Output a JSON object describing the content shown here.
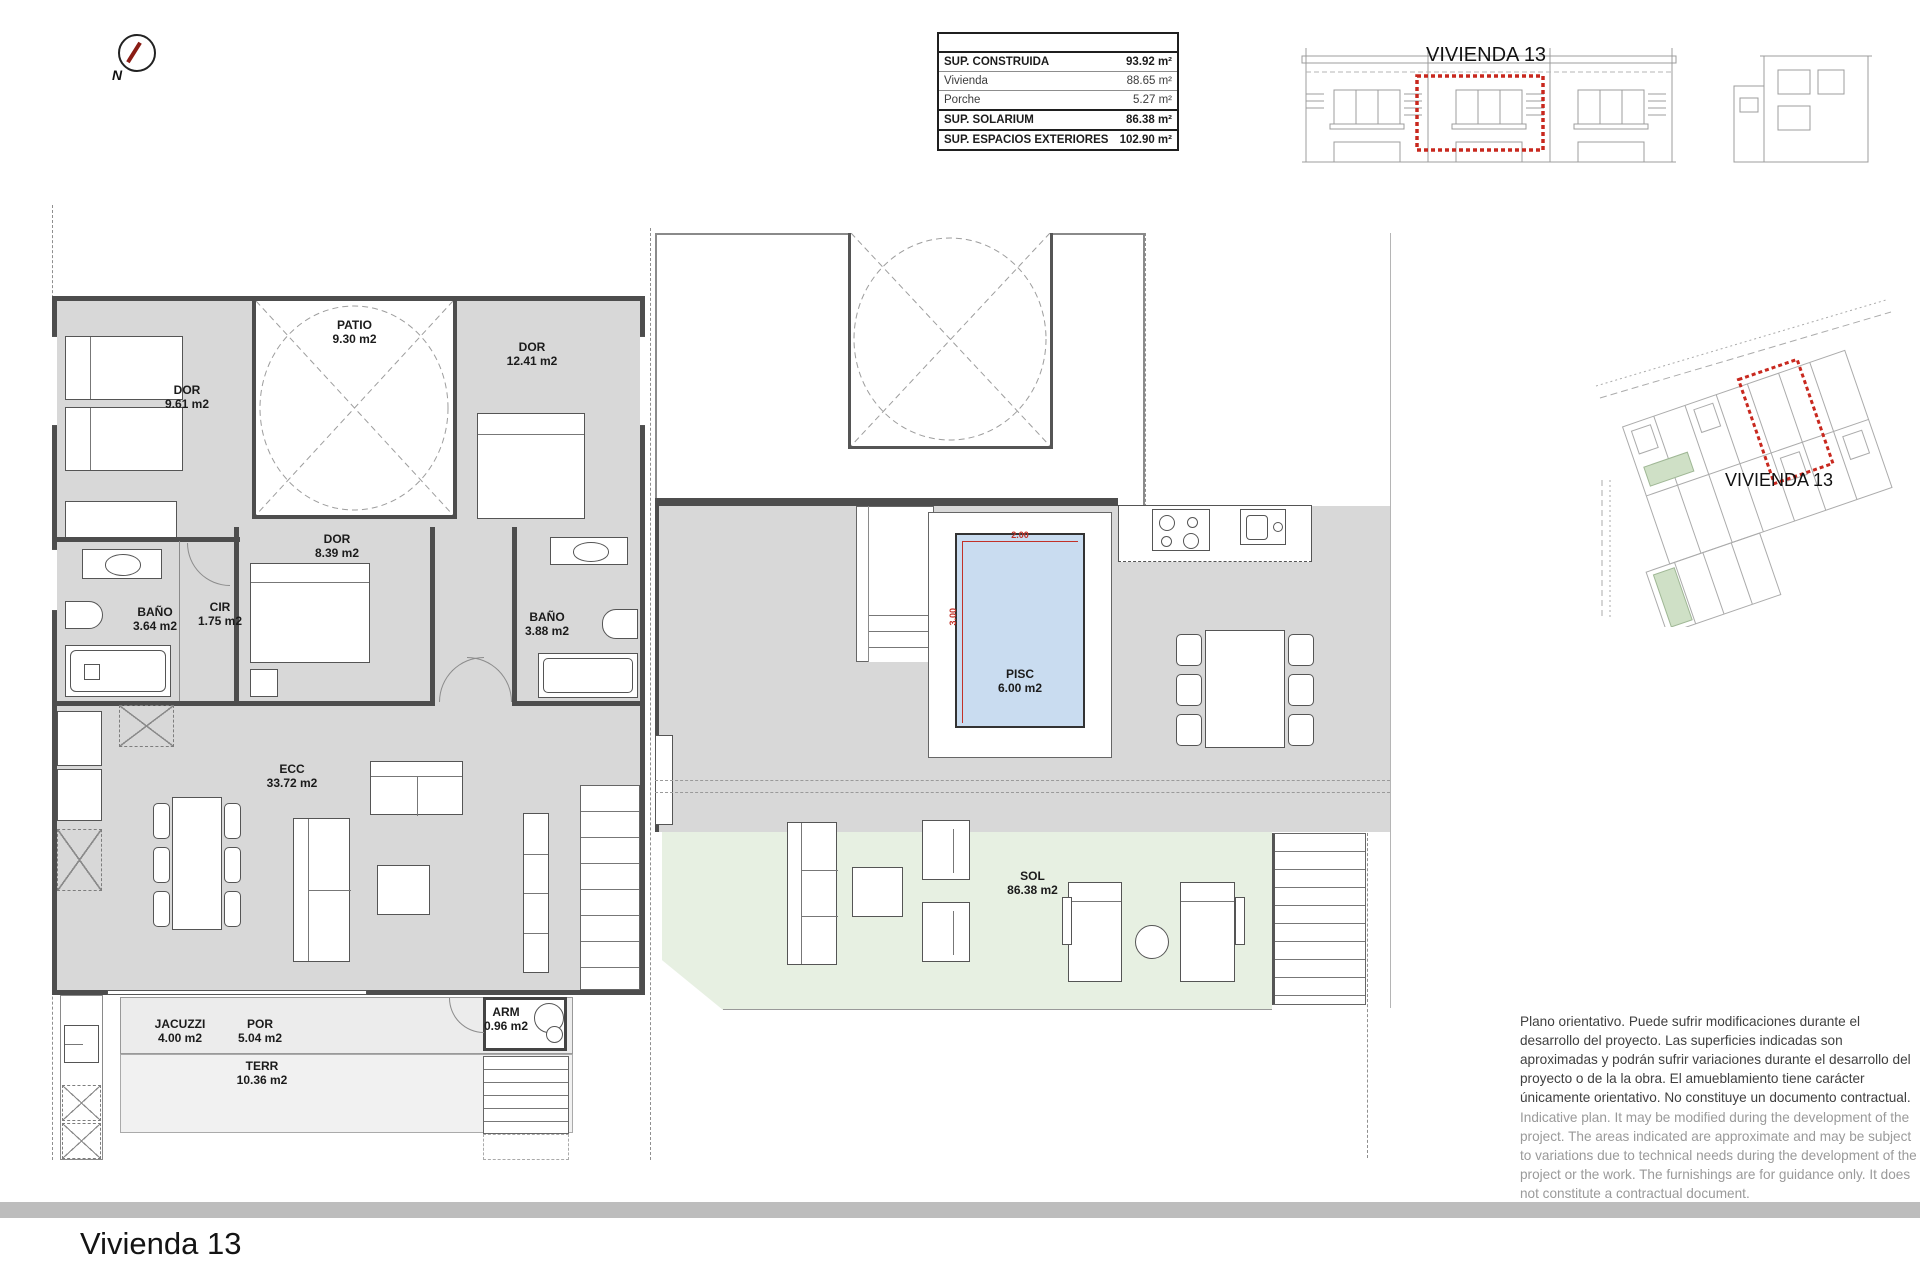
{
  "compass": {
    "label": "N"
  },
  "area_table": {
    "rows": [
      {
        "label": "SUP. CONSTRUIDA",
        "value": "93.92 m²"
      },
      {
        "label": "Vivienda",
        "value": "88.65 m²"
      },
      {
        "label": "Porche",
        "value": "5.27 m²"
      },
      {
        "label": "SUP. SOLARIUM",
        "value": "86.38 m²"
      },
      {
        "label": "SUP. ESPACIOS EXTERIORES",
        "value": "102.90 m²"
      }
    ]
  },
  "elevation": {
    "label": "VIVIENDA 13",
    "highlight_color": "#c8281e"
  },
  "site_plan": {
    "label": "VIVIENDA 13",
    "highlight_color": "#c8281e"
  },
  "floor_plan_ground": {
    "rooms": [
      {
        "name": "DOR",
        "area": "9.61 m2"
      },
      {
        "name": "PATIO",
        "area": "9.30 m2"
      },
      {
        "name": "DOR",
        "area": "12.41 m2"
      },
      {
        "name": "DOR",
        "area": "8.39 m2"
      },
      {
        "name": "BAÑO",
        "area": "3.64 m2"
      },
      {
        "name": "CIR",
        "area": "1.75 m2"
      },
      {
        "name": "BAÑO",
        "area": "3.88 m2"
      },
      {
        "name": "ECC",
        "area": "33.72 m2"
      },
      {
        "name": "JACUZZI",
        "area": "4.00 m2"
      },
      {
        "name": "POR",
        "area": "5.04 m2"
      },
      {
        "name": "TERR",
        "area": "10.36 m2"
      },
      {
        "name": "ARM",
        "area": "0.96 m2"
      }
    ]
  },
  "floor_plan_solarium": {
    "rooms": [
      {
        "name": "PISC",
        "area": "6.00 m2"
      },
      {
        "name": "SOL",
        "area": "86.38 m2"
      }
    ],
    "pool_dims": {
      "width": "2.00",
      "height": "3.00"
    },
    "colors": {
      "pool": "#c9dcf0",
      "sol": "#e7f0e2"
    }
  },
  "disclaimer": {
    "spanish": "Plano orientativo. Puede sufrir modificaciones durante el desarrollo del proyecto. Las superficies indicadas son aproximadas y podrán sufrir variaciones durante el desarrollo del proyecto o de la la obra. El amueblamiento tiene carácter únicamente orientativo. No constituye un documento contractual.",
    "english": "Indicative plan. It may be modified during the development of the project. The areas indicated are approximate and may be subject to variations due to technical needs during the development of the project or the work. The furnishings are for guidance only. It does not constitute a contractual document."
  },
  "footer": {
    "title": "Vivienda 13"
  }
}
